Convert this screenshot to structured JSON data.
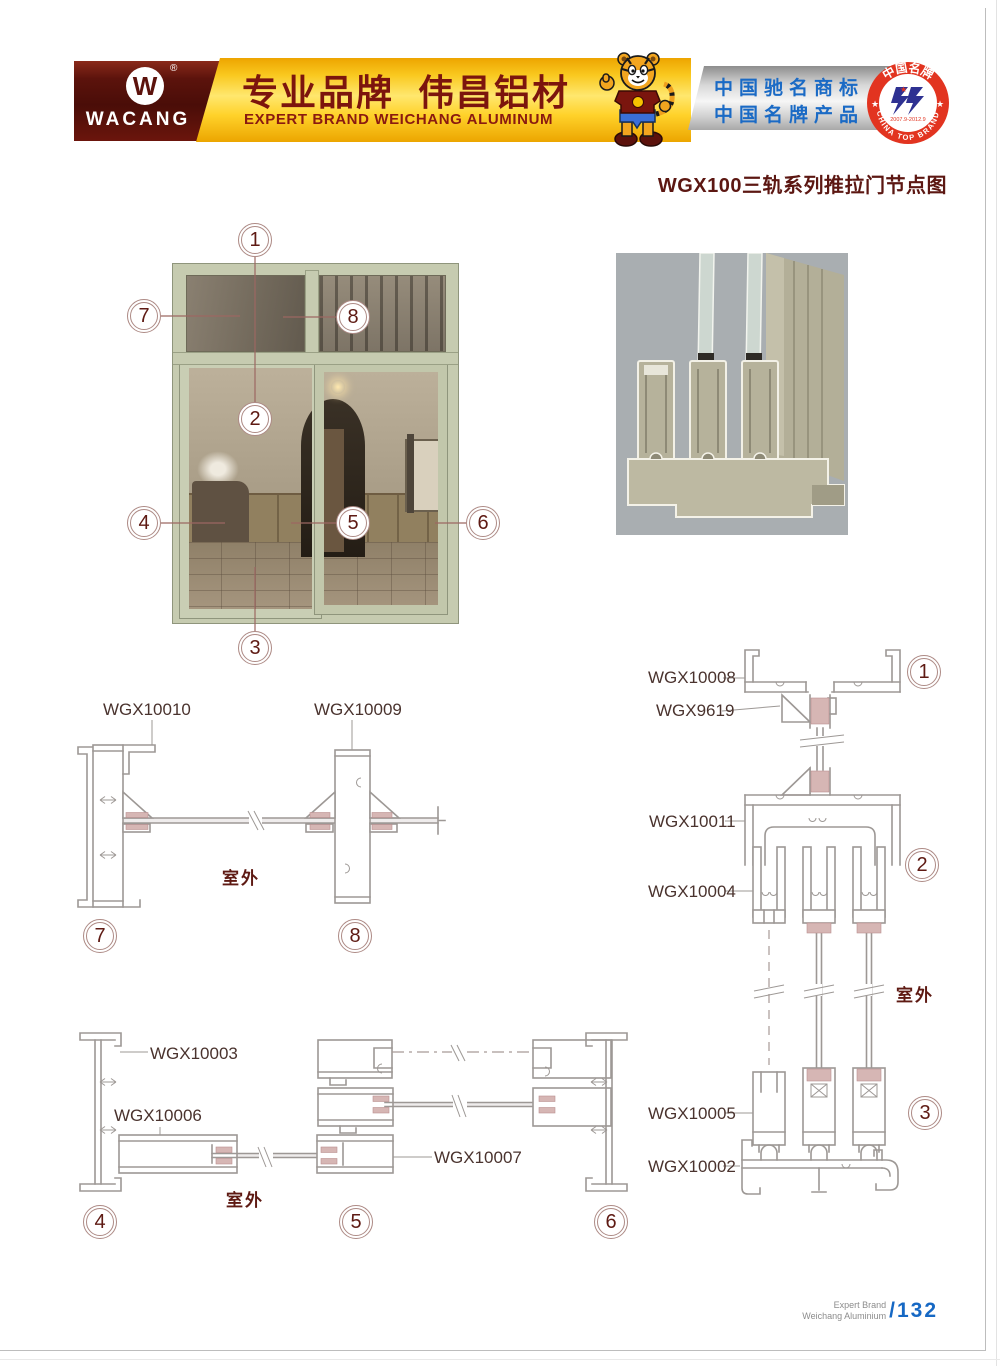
{
  "header": {
    "logo": {
      "brand": "WACANG",
      "reg": "®",
      "monogram": "W"
    },
    "banner": {
      "title_cn": "专业品牌  伟昌铝材",
      "subtitle_en": "EXPERT BRAND WEICHANG ALUMINUM"
    },
    "honors": {
      "line1": "中国驰名商标",
      "line2": "中国名牌产品"
    },
    "seal": {
      "arc_top": "中国名牌",
      "arc_bottom": "CHINA TOP BRAND",
      "years": "2007.9-2012.9"
    }
  },
  "page_title": "WGX100三轨系列推拉门节点图",
  "photo": {
    "callouts": [
      {
        "n": "1"
      },
      {
        "n": "2"
      },
      {
        "n": "3"
      },
      {
        "n": "4"
      },
      {
        "n": "5"
      },
      {
        "n": "6"
      },
      {
        "n": "7"
      },
      {
        "n": "8"
      }
    ]
  },
  "drawings": {
    "d78": {
      "labels": {
        "part1": "WGX10010",
        "part2": "WGX10009"
      },
      "outdoor": "室外",
      "callout1": "7",
      "callout2": "8"
    },
    "d123": {
      "labels": {
        "part1": "WGX10008",
        "part2": "WGX9619",
        "part3": "WGX10011",
        "part4": "WGX10004",
        "part5": "WGX10005",
        "part6": "WGX10002"
      },
      "outdoor": "室外",
      "callout1": "1",
      "callout2": "2",
      "callout3": "3"
    },
    "d456": {
      "labels": {
        "part1": "WGX10003",
        "part2": "WGX10006",
        "part3": "WGX10007"
      },
      "outdoor": "室外",
      "callout1": "4",
      "callout2": "5",
      "callout3": "6"
    }
  },
  "footer": {
    "brand_en_line1": "Expert Brand",
    "brand_en_line2": "Weichang Aluminium",
    "page_number": "/132"
  },
  "colors": {
    "accent_maroon": "#5e1a13",
    "banner_gold": "#f9c81e",
    "honor_blue": "#1a6ac5",
    "seal_red": "#e23420",
    "seal_glyph_blue": "#2e3192",
    "page_number_blue": "#1668c4",
    "drawing_line": "#9d9895",
    "glazing_pink": "#d6b6b4",
    "door_frame_green": "#c6cbb0",
    "render_background": "#a9aeb1"
  }
}
